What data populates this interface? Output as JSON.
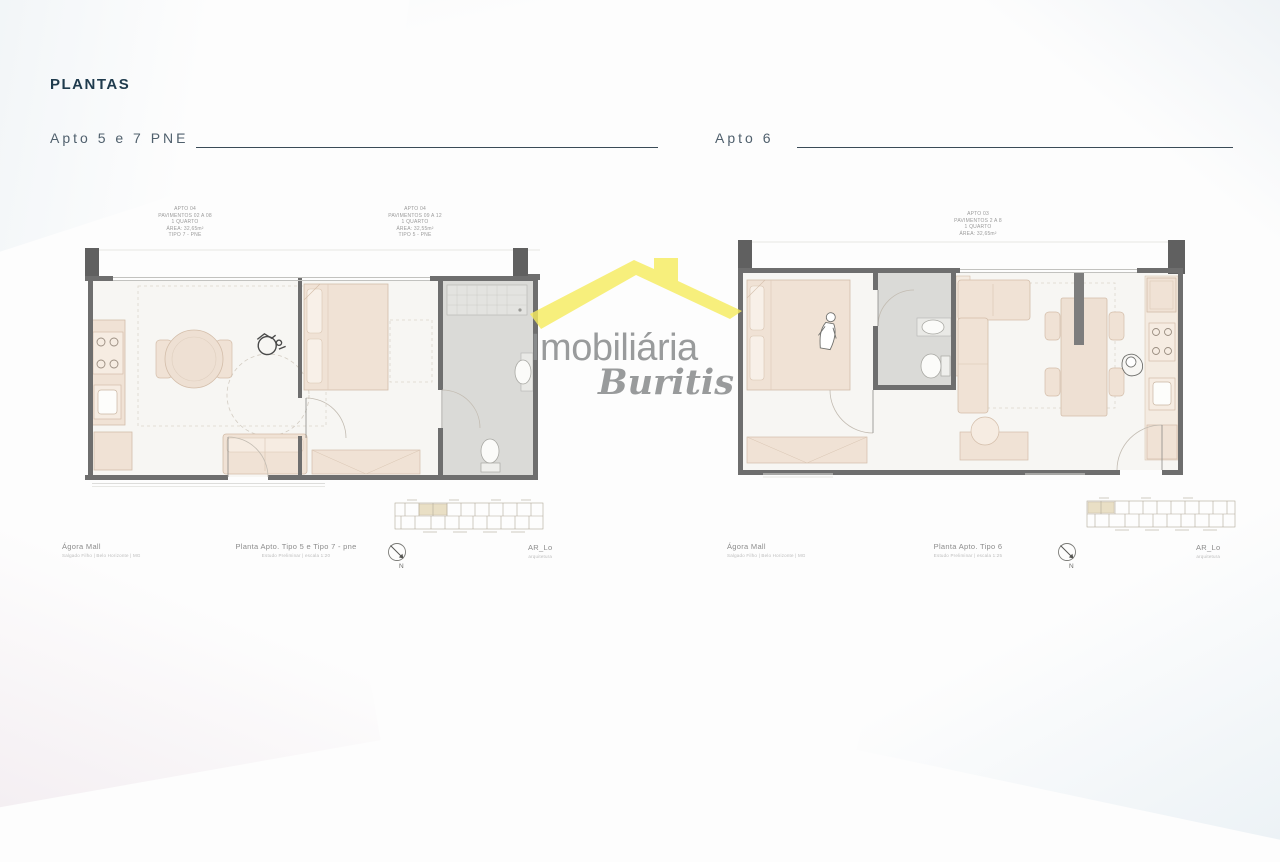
{
  "page": {
    "title": "PLANTAS"
  },
  "watermark": {
    "brand_line1": "Imobiliária",
    "brand_line2": "Buritis"
  },
  "compass": {
    "label": "N"
  },
  "left_plan": {
    "title": "Apto 5 e 7 PNE",
    "annotation_a": {
      "l1": "APTO 04",
      "l2": "PAVIMENTOS 02 A 08",
      "l3": "1 QUARTO",
      "l4": "ÁREA: 32,65m²",
      "l5": "TIPO 7 - PNE"
    },
    "annotation_b": {
      "l1": "APTO 04",
      "l2": "PAVIMENTOS 09 A 12",
      "l3": "1 QUARTO",
      "l4": "ÁREA: 32,55m²",
      "l5": "TIPO 5 - PNE"
    },
    "captions": {
      "project": "Ágora Mall",
      "project_sub": "Salgado Filho | Belo Horizonte | MG",
      "drawing": "Planta Apto. Tipo 5 e Tipo 7 - pne",
      "drawing_sub": "Estudo Preliminar | escala 1:20",
      "firm": "AR_Lo",
      "firm_sub": "arquitetura"
    }
  },
  "right_plan": {
    "title": "Apto 6",
    "annotation_a": {
      "l1": "APTO 03",
      "l2": "PAVIMENTOS 2 A 8",
      "l3": "1 QUARTO",
      "l4": "ÁREA: 32,65m²"
    },
    "captions": {
      "project": "Ágora Mall",
      "project_sub": "Salgado Filho | Belo Horizonte | MG",
      "drawing": "Planta Apto. Tipo 6",
      "drawing_sub": "Estudo Preliminar | escala 1:25",
      "firm": "AR_Lo",
      "firm_sub": "arquitetura"
    }
  },
  "colors": {
    "accent_yellow": "#f6ec5e",
    "heading": "#1f3b4d",
    "section_title": "#50606d",
    "plan_wall": "#6e6e6e",
    "furniture_fill": "#efe1d4",
    "bath_floor": "#dadad7"
  }
}
